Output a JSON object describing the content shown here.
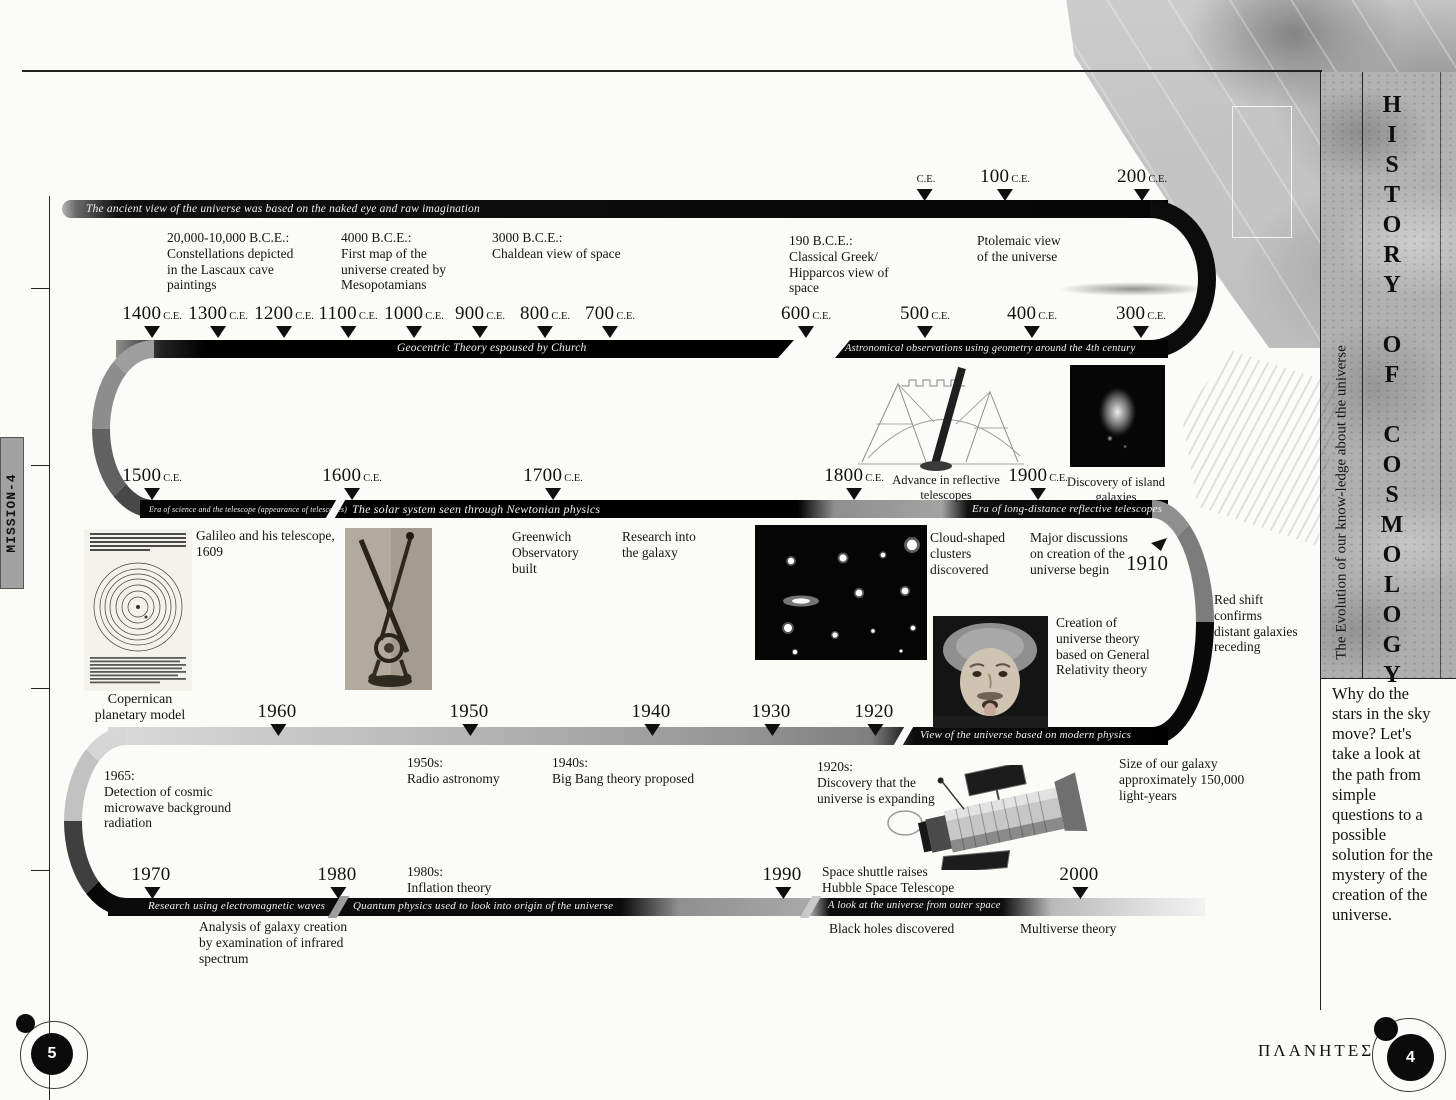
{
  "page": {
    "mission_tab": "MISSION-4",
    "footer_brand": "ΠΛΑΝΗΤΕΣ",
    "footer_left_page": "5",
    "footer_right_page": "4"
  },
  "sidebar": {
    "title": "HISTORY OF COSMOLOGY",
    "subtitle": "The Evolution of our know-ledge about the universe",
    "intro": "Why do the stars in the sky move? Let's take a look at the path from simple questions to a possible solution for the mystery of the creation of the universe."
  },
  "eras": {
    "ancient": "The ancient view of the universe was based on the naked eye and raw imagination",
    "geocentric": "Geocentric Theory espoused by Church",
    "geometry": "Astronomical observations using geometry around the 4th century",
    "telescope": "Era of science and the telescope (appearance of telescopes)",
    "newtonian": "The solar system seen through Newtonian physics",
    "long_distance": "Era of long-distance reflective telescopes",
    "modern_physics": "View of the universe based on modern physics",
    "electromagnetic": "Research using electromagnetic waves",
    "quantum": "Quantum physics used to look into origin of the universe",
    "outer_space": "A look at the universe from outer space"
  },
  "timeline": {
    "special_marker": {
      "year": "1910"
    },
    "marker_rows": [
      {
        "label_y": 166,
        "items": [
          {
            "year": "",
            "suffix": "C.E.",
            "x": 925
          },
          {
            "year": "100",
            "suffix": "C.E.",
            "x": 1005
          },
          {
            "year": "200",
            "suffix": "C.E.",
            "x": 1142
          }
        ]
      },
      {
        "label_y": 303,
        "items": [
          {
            "year": "1400",
            "suffix": "C.E.",
            "x": 152
          },
          {
            "year": "1300",
            "suffix": "C.E.",
            "x": 218
          },
          {
            "year": "1200",
            "suffix": "C.E.",
            "x": 284
          },
          {
            "year": "1100",
            "suffix": "C.E.",
            "x": 348
          },
          {
            "year": "1000",
            "suffix": "C.E.",
            "x": 414
          },
          {
            "year": "900",
            "suffix": "C.E.",
            "x": 480
          },
          {
            "year": "800",
            "suffix": "C.E.",
            "x": 545
          },
          {
            "year": "700",
            "suffix": "C.E.",
            "x": 610
          },
          {
            "year": "600",
            "suffix": "C.E.",
            "x": 806
          },
          {
            "year": "500",
            "suffix": "C.E.",
            "x": 925
          },
          {
            "year": "400",
            "suffix": "C.E.",
            "x": 1032
          },
          {
            "year": "300",
            "suffix": "C.E.",
            "x": 1141
          }
        ]
      },
      {
        "label_y": 465,
        "items": [
          {
            "year": "1500",
            "suffix": "C.E.",
            "x": 152
          },
          {
            "year": "1600",
            "suffix": "C.E.",
            "x": 352
          },
          {
            "year": "1700",
            "suffix": "C.E.",
            "x": 553
          },
          {
            "year": "1800",
            "suffix": "C.E.",
            "x": 854
          },
          {
            "year": "1900",
            "suffix": "C.E.",
            "x": 1038
          }
        ]
      },
      {
        "label_y": 701,
        "items": [
          {
            "year": "1960",
            "x": 278
          },
          {
            "year": "1950",
            "x": 470
          },
          {
            "year": "1940",
            "x": 652
          },
          {
            "year": "1930",
            "x": 772
          },
          {
            "year": "1920",
            "x": 875
          }
        ]
      },
      {
        "label_y": 864,
        "items": [
          {
            "year": "1970",
            "x": 152
          },
          {
            "year": "1980",
            "x": 338
          },
          {
            "year": "1990",
            "x": 783
          },
          {
            "year": "2000",
            "x": 1080
          }
        ]
      }
    ],
    "events": [
      {
        "id": "lascaux",
        "x": 167,
        "y": 230,
        "text": "20,000-10,000 B.C.E.:\nConstellations depicted\nin the Lascaux cave\npaintings"
      },
      {
        "id": "mesopotamia",
        "x": 341,
        "y": 230,
        "text": "4000 B.C.E.:\nFirst map of the\nuniverse created by\nMesopotamians"
      },
      {
        "id": "chaldean",
        "x": 492,
        "y": 230,
        "text": "3000 B.C.E.:\nChaldean view of space"
      },
      {
        "id": "hipparcos",
        "x": 789,
        "y": 233,
        "text": "190 B.C.E.:\nClassical Greek/\nHipparcos view of\nspace"
      },
      {
        "id": "ptolemaic",
        "x": 977,
        "y": 233,
        "text": "Ptolemaic view\nof the universe"
      },
      {
        "id": "advance-reflective",
        "x": 946,
        "y": 473,
        "center": true,
        "size": 12.5,
        "text": "Advance in reflective\ntelescopes"
      },
      {
        "id": "island-galaxies",
        "x": 1116,
        "y": 475,
        "center": true,
        "size": 12.5,
        "text": "Discovery of island\ngalaxies"
      },
      {
        "id": "galileo",
        "x": 196,
        "y": 528,
        "text": "Galileo and his telescope,\n1609"
      },
      {
        "id": "greenwich",
        "x": 512,
        "y": 529,
        "text": "Greenwich\nObservatory\nbuilt"
      },
      {
        "id": "galaxy-research",
        "x": 622,
        "y": 529,
        "text": "Research into\nthe galaxy"
      },
      {
        "id": "cloud-clusters",
        "x": 930,
        "y": 530,
        "text": "Cloud-shaped\nclusters\ndiscovered"
      },
      {
        "id": "creation-discussions",
        "x": 1030,
        "y": 530,
        "text": "Major discussions\non creation of the\nuniverse begin"
      },
      {
        "id": "relativity",
        "x": 1056,
        "y": 615,
        "text": "Creation of\nuniverse theory\nbased on General\nRelativity theory"
      },
      {
        "id": "red-shift",
        "x": 1214,
        "y": 592,
        "text": "Red shift\nconfirms\ndistant galaxies\nreceding"
      },
      {
        "id": "copernican-caption",
        "x": 140,
        "y": 692,
        "center": true,
        "size": 14,
        "text": "Copernican\nplanetary model"
      },
      {
        "id": "cmb-1965",
        "x": 104,
        "y": 768,
        "text": "1965:\nDetection of cosmic\nmicrowave background\nradiation"
      },
      {
        "id": "radio-1950s",
        "x": 407,
        "y": 755,
        "text": "1950s:\nRadio astronomy"
      },
      {
        "id": "bigbang-1940s",
        "x": 552,
        "y": 755,
        "text": "1940s:\nBig Bang theory proposed"
      },
      {
        "id": "expanding-1920s",
        "x": 817,
        "y": 759,
        "text": "1920s:\nDiscovery that the\nuniverse is expanding"
      },
      {
        "id": "galaxy-size",
        "x": 1119,
        "y": 756,
        "text": "Size of our galaxy\napproximately 150,000\nlight-years"
      },
      {
        "id": "inflation-1980s",
        "x": 407,
        "y": 864,
        "text": "1980s:\nInflation theory"
      },
      {
        "id": "hubble-launch",
        "x": 822,
        "y": 864,
        "text": "Space shuttle raises\nHubble Space Telescope"
      },
      {
        "id": "infrared-analysis",
        "x": 199,
        "y": 919,
        "text": "Analysis of galaxy creation\nby examination of infrared\nspectrum"
      },
      {
        "id": "black-holes",
        "x": 829,
        "y": 921,
        "text": "Black holes discovered"
      },
      {
        "id": "multiverse",
        "x": 1020,
        "y": 921,
        "text": "Multiverse theory"
      }
    ]
  },
  "colors": {
    "band_black": "#0c0c0c",
    "paper": "#fbfbf8"
  }
}
